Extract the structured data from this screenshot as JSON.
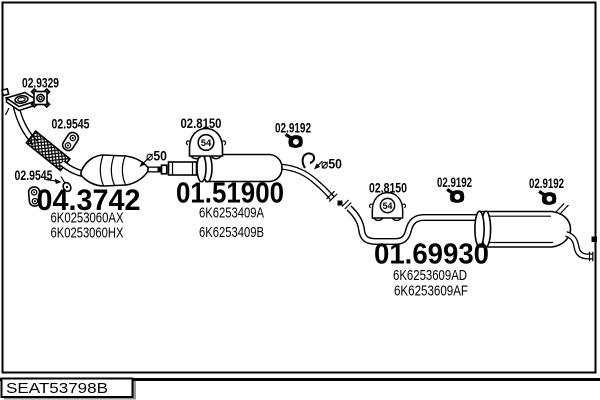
{
  "footer": {
    "drawing_ref": "SEAT53798B"
  },
  "labels": {
    "gasket_ref": "02.9329",
    "front_hanger_ref_1": "02.9545",
    "front_hanger_ref_2": "02.9545",
    "mount_ref_front": "02.8150",
    "mount_ref_rear": "02.8150",
    "mount_size": "54",
    "clamp_ref_1": "02.9192",
    "clamp_ref_2": "02.9192",
    "clamp_ref_3": "02.9192",
    "pipe_diameter_1": "⌀50",
    "pipe_diameter_2": "⌀50"
  },
  "assemblies": {
    "catalyst": {
      "part_no": "04.3742",
      "oem_code_1": "6K0253060AX",
      "oem_code_2": "6K0253060HX"
    },
    "centre_silencer": {
      "part_no": "01.51900",
      "oem_code_1": "6K6253409A",
      "oem_code_2": "6K6253409B"
    },
    "rear_silencer": {
      "part_no": "01.69930",
      "oem_code_1": "6K6253609AD",
      "oem_code_2": "6K6253609AF"
    }
  },
  "colors": {
    "ink": "#000000",
    "paper": "#ffffff",
    "shadow": "#999999"
  }
}
